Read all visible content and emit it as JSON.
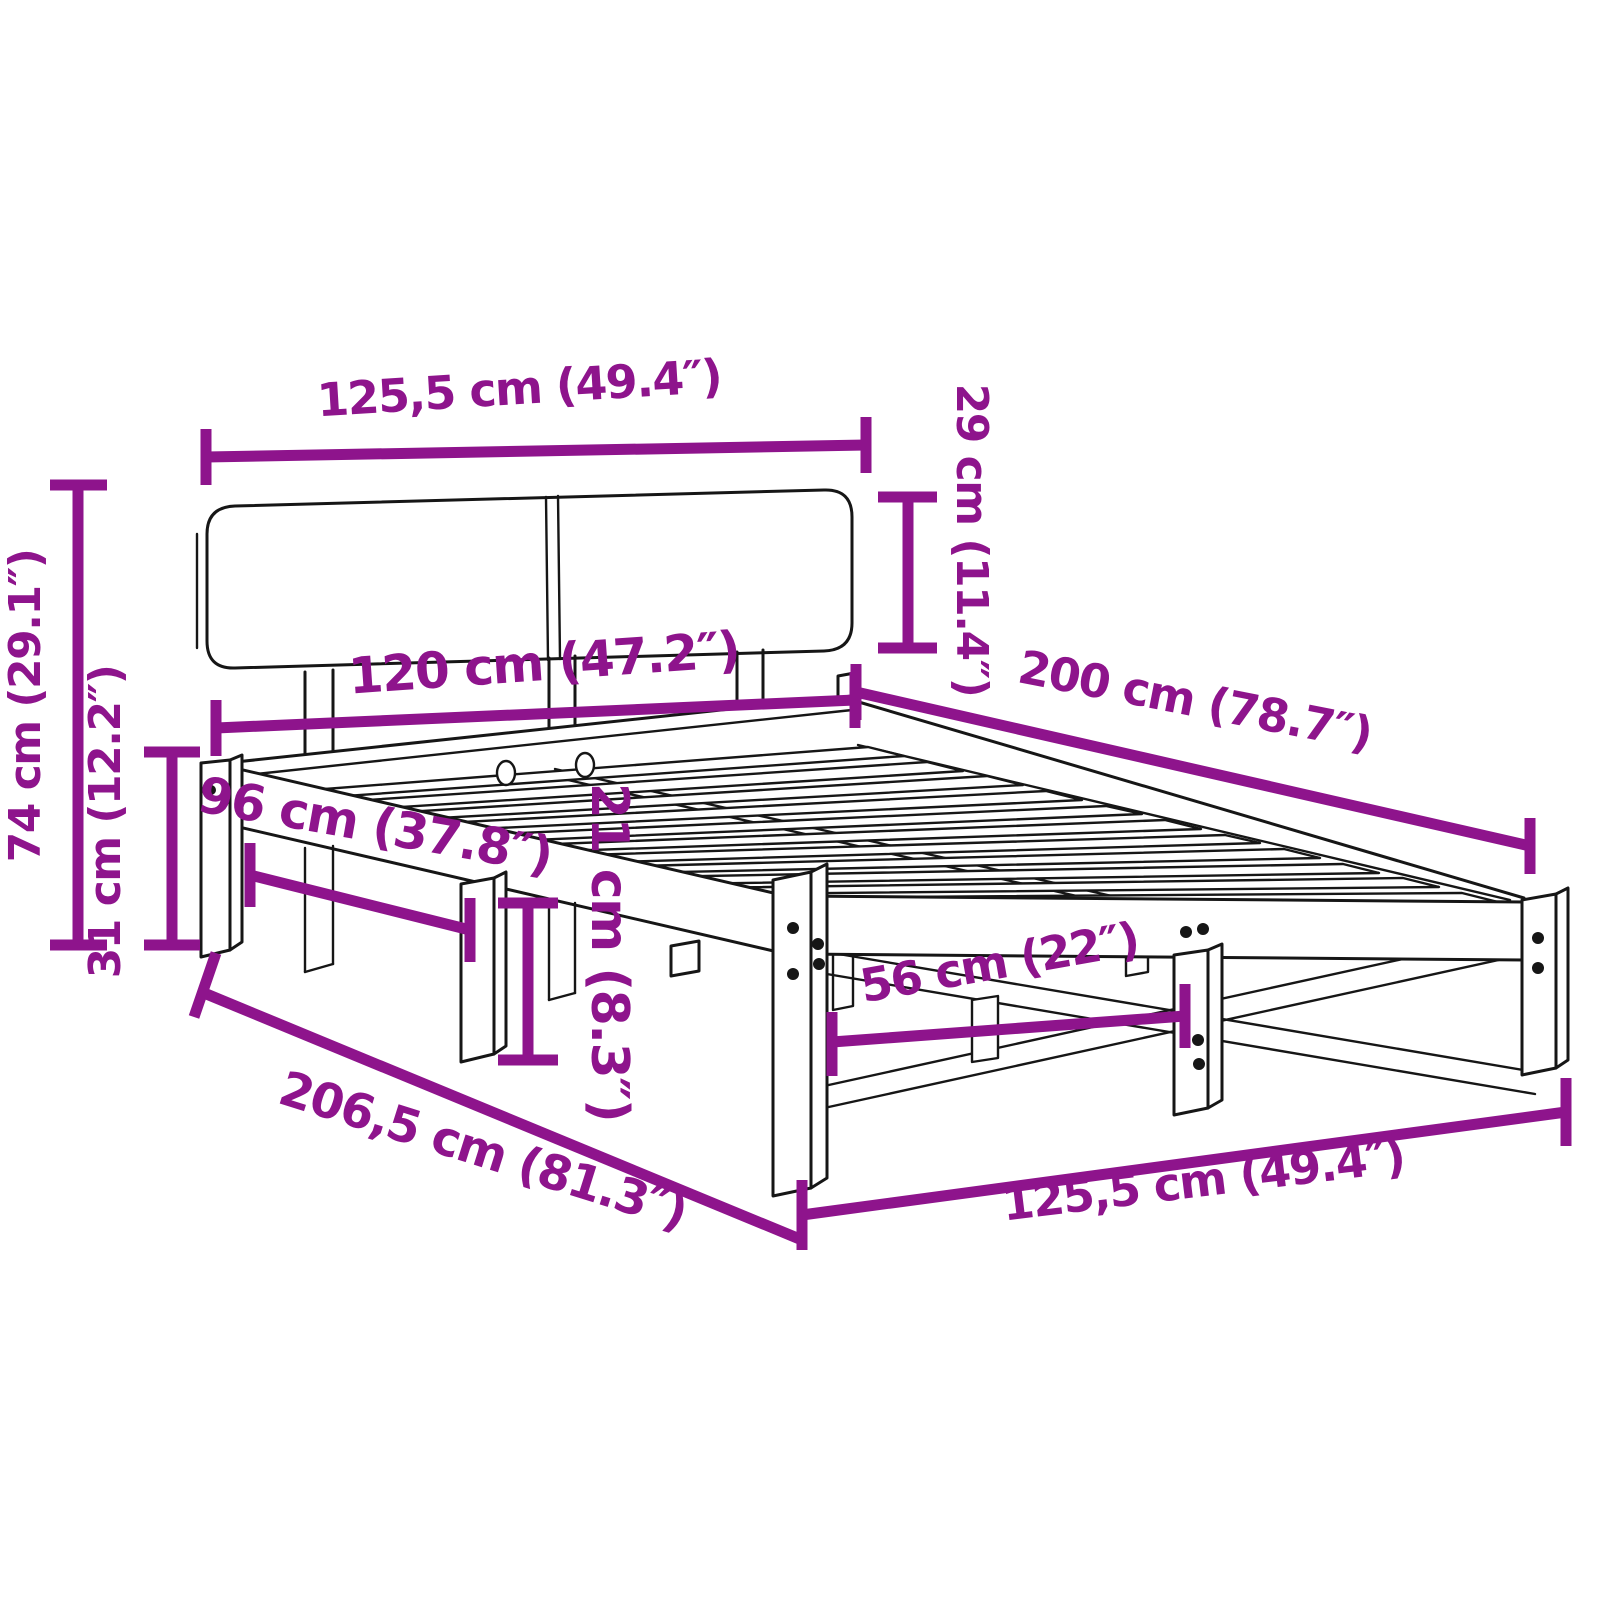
{
  "figure": {
    "type": "product-dimension-diagram",
    "subject": "Wooden bed frame with two-panel headboard, slatted base and support legs",
    "background_color": "#ffffff",
    "outline_color": "#161616",
    "dimension_color": "#8e148c"
  },
  "dims": {
    "headboard_width": {
      "label": "125,5 cm (49.4″)",
      "value_cm": 125.5,
      "value_in": 49.4
    },
    "headboard_height": {
      "label": "29 cm (11.4″)",
      "value_cm": 29,
      "value_in": 11.4
    },
    "bed_width": {
      "label": "120 cm (47.2″)",
      "value_cm": 120,
      "value_in": 47.2
    },
    "bed_length": {
      "label": "200 cm (78.7″)",
      "value_cm": 200,
      "value_in": 78.7
    },
    "total_height": {
      "label": "74 cm (29.1″)",
      "value_cm": 74,
      "value_in": 29.1
    },
    "base_height": {
      "label": "31 cm (12.2″)",
      "value_cm": 31,
      "value_in": 12.2
    },
    "side_leg_spacing": {
      "label": "96 cm (37.8″)",
      "value_cm": 96,
      "value_in": 37.8
    },
    "clearance_height": {
      "label": "21 cm (8.3″)",
      "value_cm": 21,
      "value_in": 8.3
    },
    "total_length": {
      "label": "206,5 cm (81.3″)",
      "value_cm": 206.5,
      "value_in": 81.3
    },
    "foot_leg_spacing": {
      "label": "56 cm (22″)",
      "value_cm": 56,
      "value_in": 22
    },
    "base_width": {
      "label": "125,5 cm (49.4″)",
      "value_cm": 125.5,
      "value_in": 49.4
    }
  }
}
